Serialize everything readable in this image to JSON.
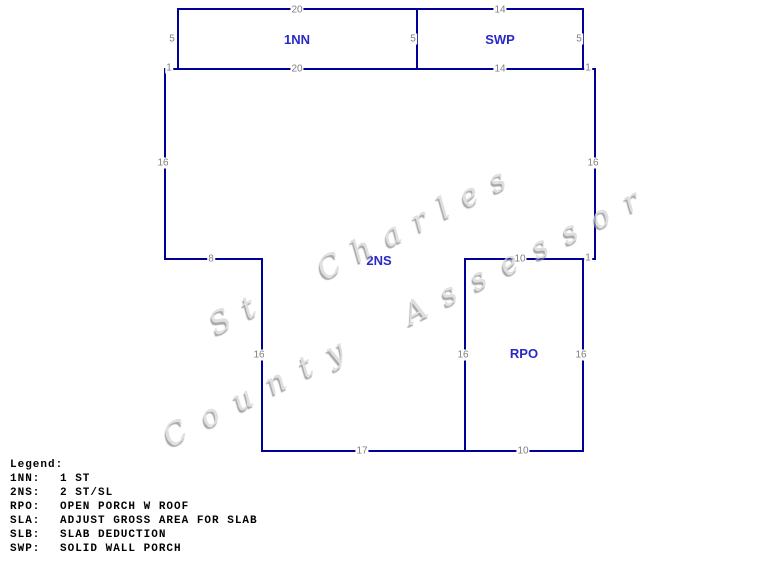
{
  "sketch": {
    "area_labels": {
      "nn1": "1NN",
      "swp": "SWP",
      "ns2": "2NS",
      "rpo": "RPO"
    },
    "dimensions": {
      "top_1nn_top": "20",
      "top_1nn_bottom": "20",
      "top_swp_top": "14",
      "top_swp_bottom": "14",
      "side_1nn_left": "5",
      "side_1nn_right": "5",
      "side_swp_right": "5",
      "tick_top_left": "1",
      "tick_top_right": "1",
      "tick_rpo_top_right": "1",
      "main_left": "16",
      "main_right": "16",
      "step_left": "8",
      "rpo_top": "10",
      "lower_left": "16",
      "interior_wall": "16",
      "rpo_right": "16",
      "bottom_2ns": "17",
      "rpo_bottom": "10"
    },
    "colors": {
      "line": "#000099",
      "area_label": "#2929c8",
      "dimension": "#808080"
    }
  },
  "watermark": {
    "line1": "St Charles",
    "line2": "County Assessor"
  },
  "legend": {
    "title": "Legend:",
    "entries": [
      {
        "code": "1NN:",
        "description": "1 ST"
      },
      {
        "code": "2NS:",
        "description": "2 ST/SL"
      },
      {
        "code": "RPO:",
        "description": "OPEN PORCH W ROOF"
      },
      {
        "code": "SLA:",
        "description": "ADJUST GROSS AREA FOR SLAB"
      },
      {
        "code": "SLB:",
        "description": "SLAB DEDUCTION"
      },
      {
        "code": "SWP:",
        "description": "SOLID WALL PORCH"
      }
    ]
  }
}
